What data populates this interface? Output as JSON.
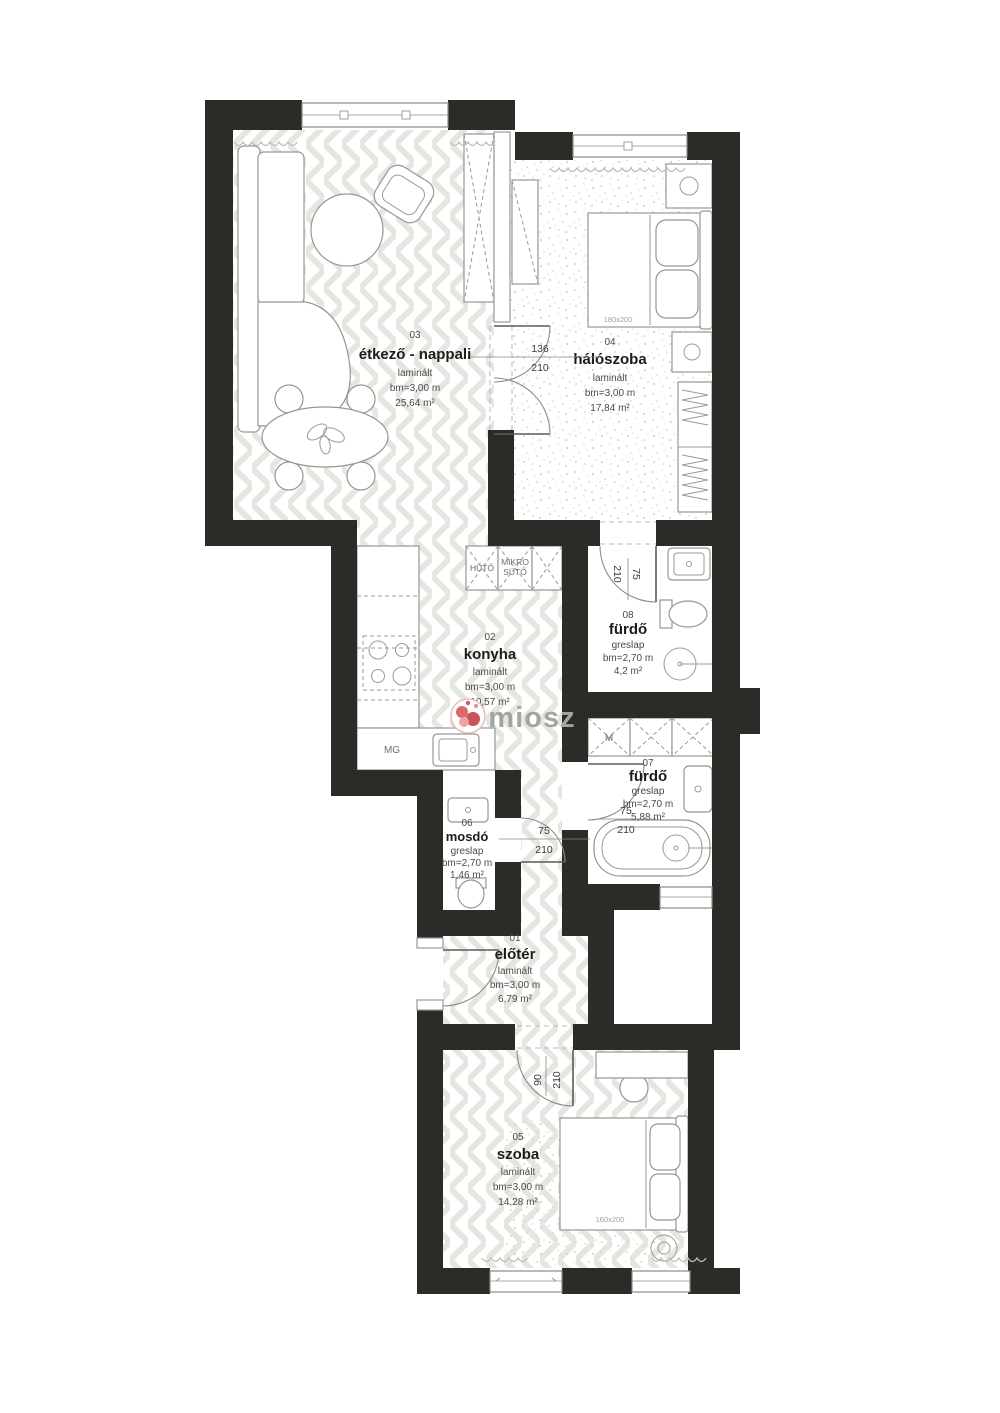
{
  "watermark": {
    "brand": "miosz"
  },
  "rooms": [
    {
      "num": "01",
      "name": "előtér",
      "floor": "laminált",
      "clearance": "bm=3,00 m",
      "area": "6,79 m²"
    },
    {
      "num": "02",
      "name": "konyha",
      "floor": "laminált",
      "clearance": "bm=3,00 m",
      "area": "10,57 m²"
    },
    {
      "num": "03",
      "name": "étkező - nappali",
      "floor": "laminált",
      "clearance": "bm=3,00 m",
      "area": "25,64 m²"
    },
    {
      "num": "04",
      "name": "hálószoba",
      "floor": "laminált",
      "clearance": "bm=3,00 m",
      "area": "17,84 m²"
    },
    {
      "num": "05",
      "name": "szoba",
      "floor": "laminált",
      "clearance": "bm=3,00 m",
      "area": "14,28 m²"
    },
    {
      "num": "06",
      "name": "mosdó",
      "floor": "greslap",
      "clearance": "bm=2,70 m",
      "area": "1,46 m²"
    },
    {
      "num": "07",
      "name": "fürdő",
      "floor": "greslap",
      "clearance": "bm=2,70 m",
      "area": "5,88 m²"
    },
    {
      "num": "08",
      "name": "fürdő",
      "floor": "greslap",
      "clearance": "bm=2,70 m",
      "area": "4,2 m²"
    }
  ],
  "doors": [
    {
      "w": "136",
      "h": "210"
    },
    {
      "w": "75",
      "h": "210"
    },
    {
      "w": "75",
      "h": "210"
    },
    {
      "w": "75",
      "h": "210"
    },
    {
      "w": "90",
      "h": "210"
    }
  ],
  "appliances": {
    "fridge": "HŰTŐ",
    "microwave_line1": "MIKRO",
    "microwave_line2": "SÜTŐ",
    "dishwasher": "MG",
    "washer": "M"
  },
  "furniture": {
    "bed_master": "180x200",
    "bed_second": "160x200"
  },
  "colors": {
    "wall": "#2d2b28",
    "logo_accent": "#c85555"
  }
}
